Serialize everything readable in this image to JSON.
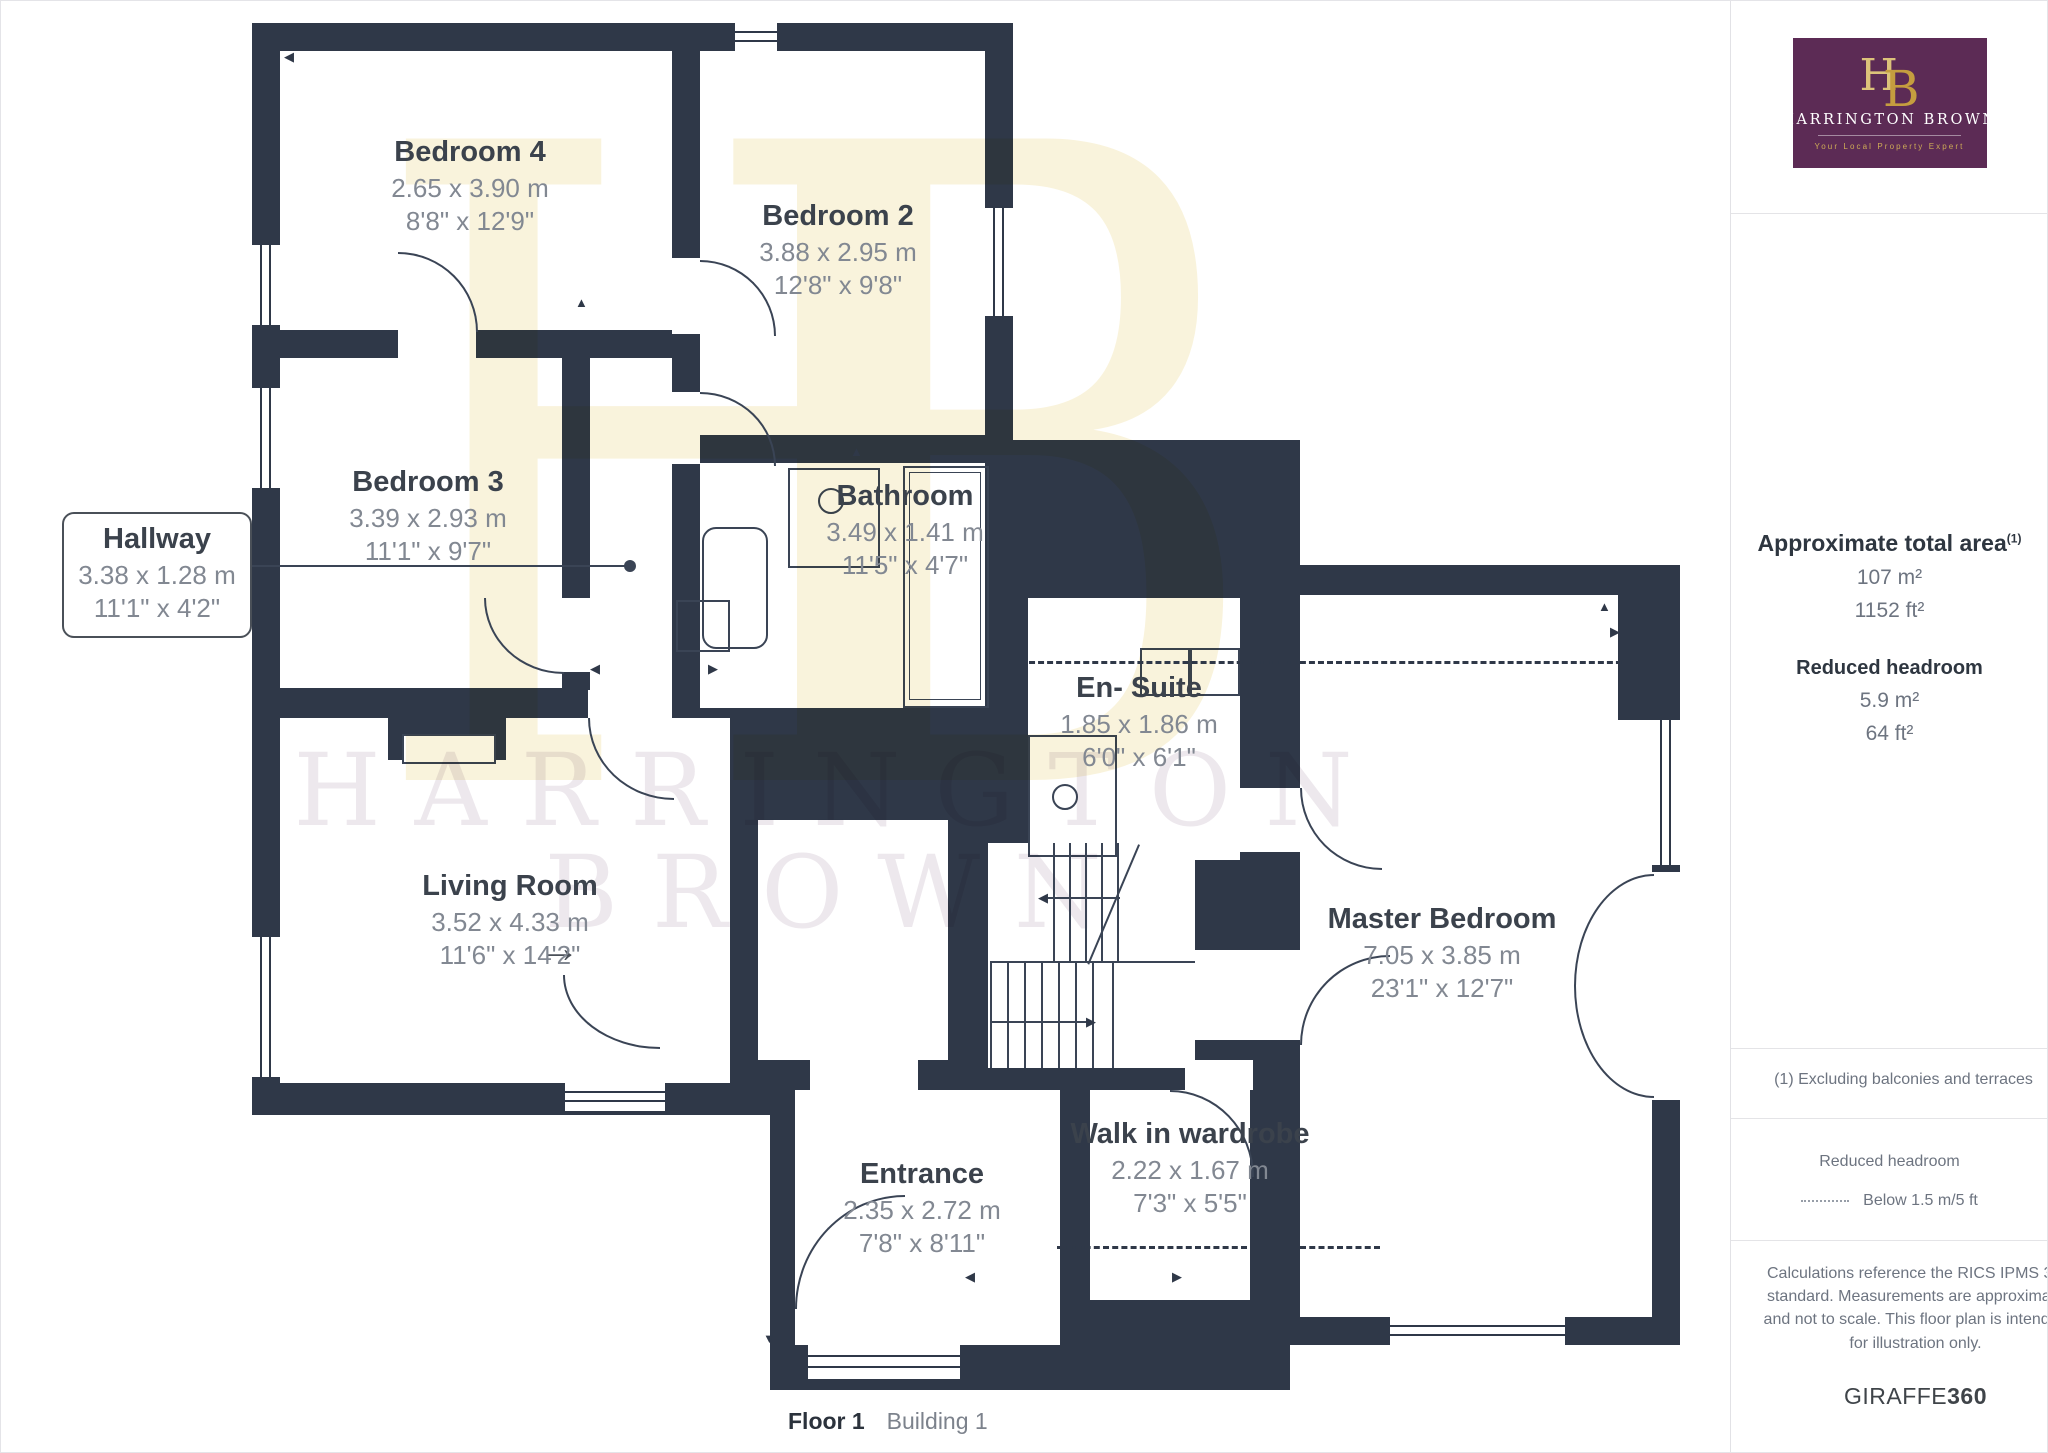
{
  "colors": {
    "wall": "#2F3848",
    "brand_purple": "#5C2B55",
    "brand_gold": "#C9A959",
    "label_dark": "#3B424C",
    "label_gray": "#828892",
    "watermark_yellow": "#F6ECC6",
    "watermark_gray": "#DCD2DC"
  },
  "logo": {
    "h": "H",
    "b": "B",
    "name": "HARRINGTON BROWN",
    "tagline": "Your Local Property Expert"
  },
  "watermark": {
    "monogram": "HB",
    "line1": "HARRINGTON",
    "line2": "BROWN"
  },
  "rooms": [
    {
      "name": "Bedroom 4",
      "metric": "2.65 x 3.90 m",
      "imperial": "8'8\" x 12'9\""
    },
    {
      "name": "Bedroom 2",
      "metric": "3.88 x 2.95 m",
      "imperial": "12'8\" x 9'8\""
    },
    {
      "name": "Bedroom 3",
      "metric": "3.39 x 2.93 m",
      "imperial": "11'1\" x 9'7\""
    },
    {
      "name": "Hallway",
      "metric": "3.38 x 1.28 m",
      "imperial": "11'1\" x 4'2\""
    },
    {
      "name": "Bathroom",
      "metric": "3.49 x 1.41 m",
      "imperial": "11'5\" x 4'7\""
    },
    {
      "name": "En- Suite",
      "metric": "1.85 x 1.86 m",
      "imperial": "6'0\" x 6'1\""
    },
    {
      "name": "Living Room",
      "metric": "3.52 x 4.33 m",
      "imperial": "11'6\" x 14'2\""
    },
    {
      "name": "Master Bedroom",
      "metric": "7.05 x 3.85 m",
      "imperial": "23'1\" x 12'7\""
    },
    {
      "name": "Walk in wardrobe",
      "metric": "2.22 x 1.67 m",
      "imperial": "7'3\" x 5'5\""
    },
    {
      "name": "Entrance",
      "metric": "2.35 x 2.72 m",
      "imperial": "7'8\" x 8'11\""
    }
  ],
  "sidebar": {
    "total_area": {
      "title": "Approximate total area",
      "marker": "(1)",
      "m2": "107 m²",
      "ft2": "1152 ft²"
    },
    "reduced_headroom": {
      "title": "Reduced headroom",
      "m2": "5.9 m²",
      "ft2": "64 ft²"
    },
    "footnote": "(1) Excluding balconies and terraces",
    "legend": {
      "title": "Reduced headroom",
      "label": "Below 1.5 m/5 ft"
    },
    "disclaimer": "Calculations reference the RICS IPMS 3C standard. Measurements are approximate and not to scale. This floor plan is intended for illustration only.",
    "brand": {
      "name": "GIRAFFE",
      "suffix": "360"
    }
  },
  "caption": {
    "floor": "Floor 1",
    "building": "Building 1"
  }
}
